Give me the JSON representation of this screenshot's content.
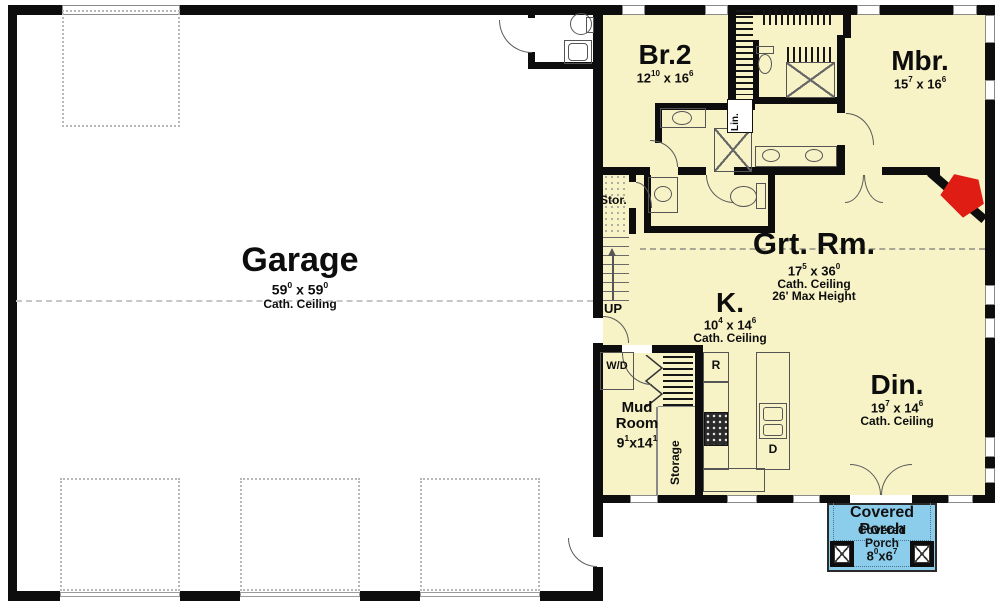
{
  "colors": {
    "house_fill": "#f7f3c6",
    "porch_fill": "#8dcdec",
    "fireplace_red": "#e01d15",
    "wall": "#0d0d0d"
  },
  "rooms": {
    "garage": {
      "label": "Garage",
      "w": "59",
      "wsup": "0",
      "sep": " x ",
      "h": "59",
      "hsup": "0",
      "ceiling": "Cath. Ceiling"
    },
    "br2": {
      "label": "Br.2",
      "w": "12",
      "wsup": "10",
      "sep": " x ",
      "h": "16",
      "hsup": "6"
    },
    "mbr": {
      "label": "Mbr.",
      "w": "15",
      "wsup": "7",
      "sep": " x ",
      "h": "16",
      "hsup": "6"
    },
    "grt": {
      "label": "Grt. Rm.",
      "w": "17",
      "wsup": "5",
      "sep": " x ",
      "h": "36",
      "hsup": "0",
      "ceiling": "Cath. Ceiling",
      "height_note": "26' Max Height"
    },
    "kitchen": {
      "label": "K.",
      "w": "10",
      "wsup": "4",
      "sep": " x ",
      "h": "14",
      "hsup": "6",
      "ceiling": "Cath. Ceiling"
    },
    "din": {
      "label": "Din.",
      "w": "19",
      "wsup": "7",
      "sep": " x ",
      "h": "14",
      "hsup": "6",
      "ceiling": "Cath. Ceiling"
    },
    "mud": {
      "line1": "Mud",
      "line2": "Room",
      "w": "9",
      "wsup": "1",
      "sep": "x",
      "h": "14",
      "hsup": "1"
    }
  },
  "porch": {
    "big1": "Covered",
    "big2": "Porch",
    "small1": "Covered",
    "small2": "Porch",
    "w": "8",
    "wsup": "0",
    "sep": "x",
    "h": "6",
    "hsup": "7"
  },
  "labels": {
    "stor": "Stor.",
    "up": "UP",
    "wd": "W/D",
    "storage": "Storage",
    "lin": "Lin.",
    "fridge": "R",
    "dishwasher": "D"
  }
}
